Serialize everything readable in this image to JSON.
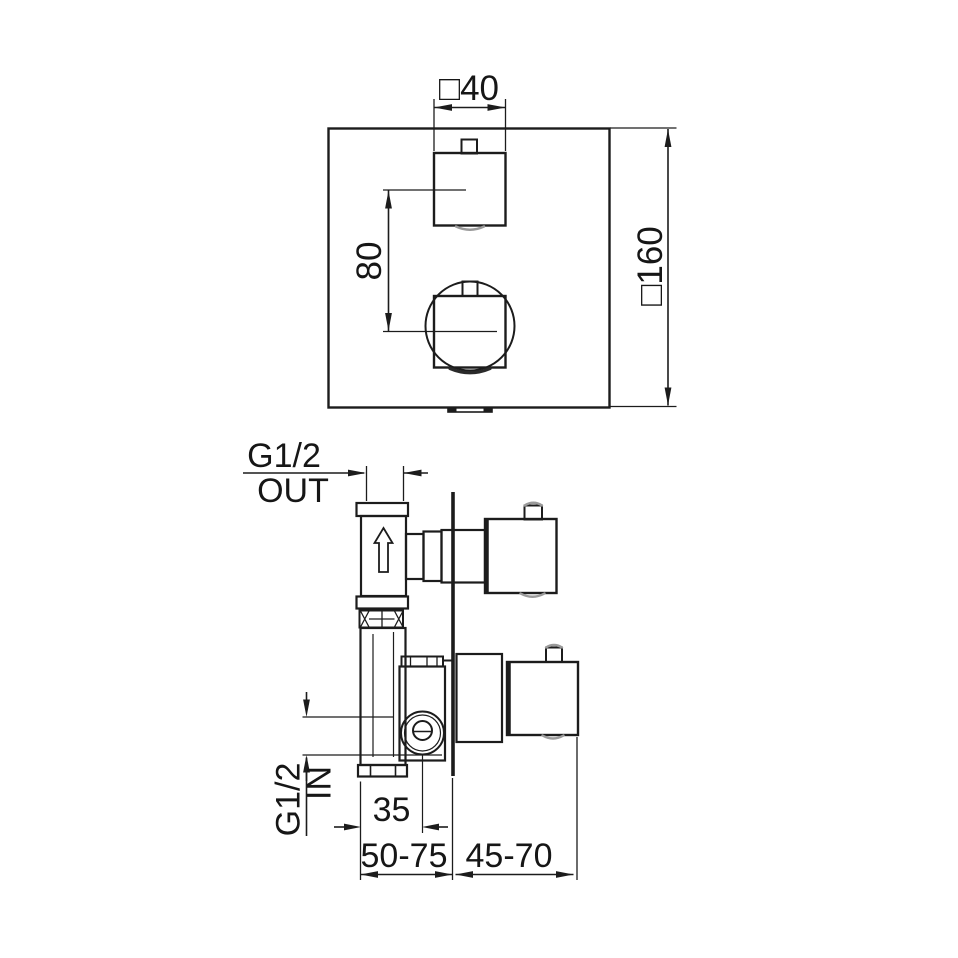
{
  "colors": {
    "line": "#1c1c1c",
    "gray_accent": "#9a9a9a",
    "background": "#ffffff"
  },
  "front_view": {
    "dim_handle_width": "□40",
    "dim_plate_size": "□160",
    "dim_handle_centers": "80"
  },
  "side_view": {
    "outlet": {
      "thread": "G1/2",
      "label": "OUT"
    },
    "inlet": {
      "thread": "G1/2",
      "label": "IN"
    },
    "dim_inlet_center_offset": "35",
    "dim_installation_depth_wall": "50-75",
    "dim_installation_depth_trim": "45-70"
  }
}
